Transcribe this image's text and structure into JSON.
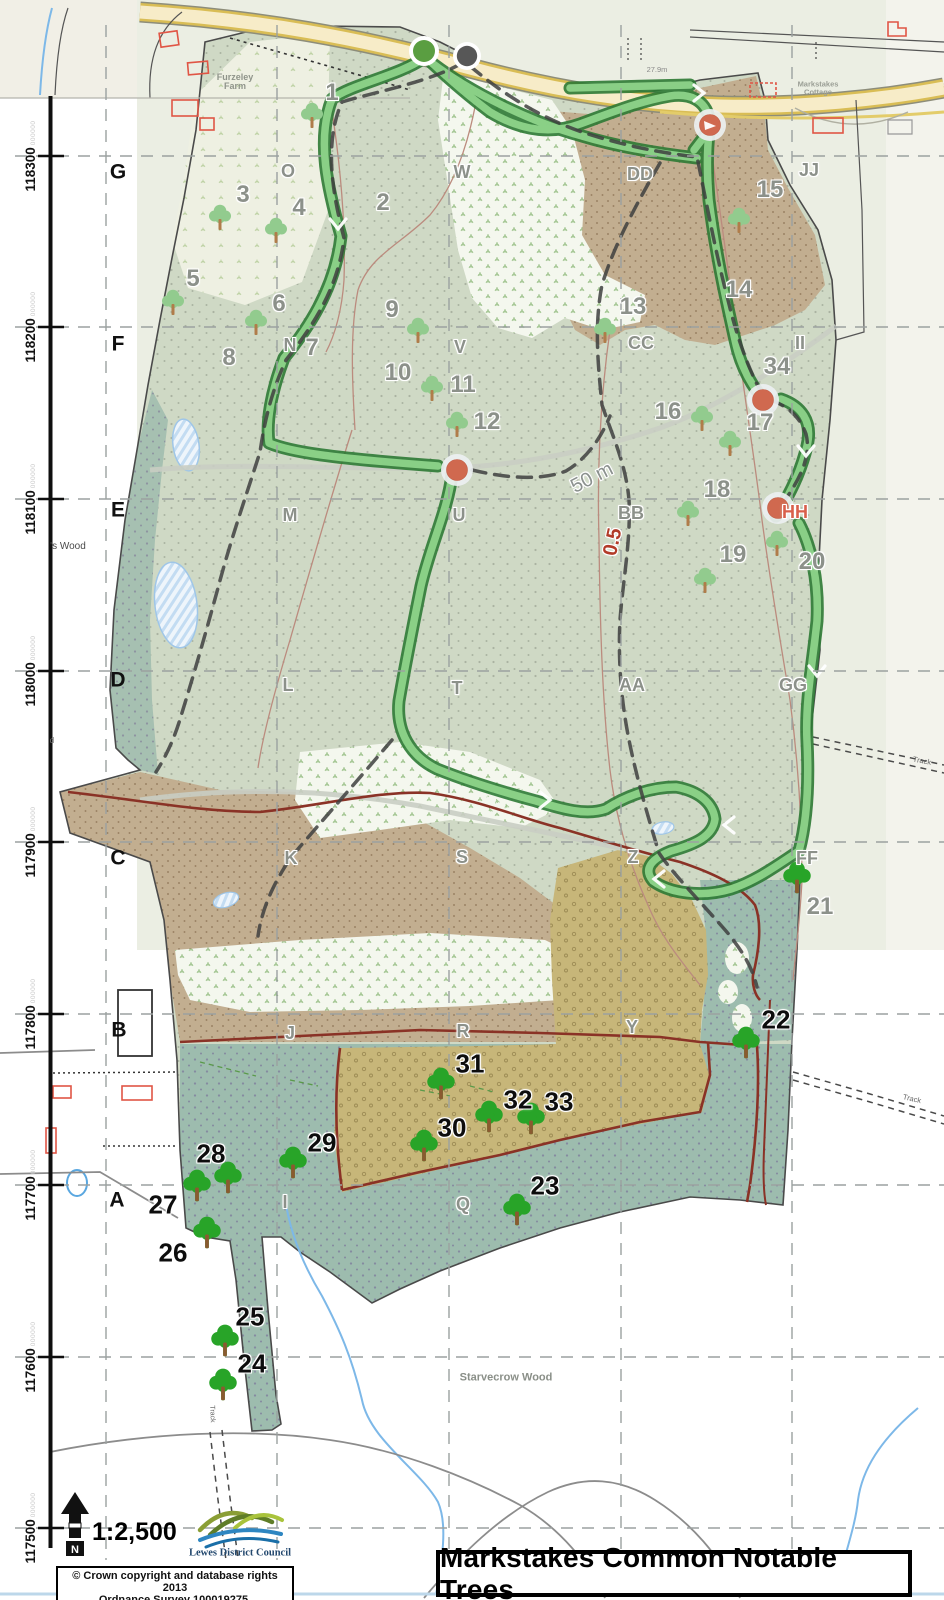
{
  "map": {
    "title": "Markstakes Common Notable Trees",
    "scale_label": "1:2,500",
    "north_label": "N",
    "attribution_line1": "© Crown copyright and database rights 2013",
    "attribution_line2": "Ordnance Survey 100019275.",
    "logo_label": "Lewes District Council",
    "colors": {
      "trail_green": "#8ed48a",
      "trail_casing": "#2e7a35",
      "waypoint_red": "#d0694f",
      "start_green": "#5a9e41",
      "start_gray": "#575757",
      "track_maroon": "#8a3226",
      "stream_blue": "#7db8e8",
      "gray_label": "#8c918a",
      "hh_red": "#d95f4b",
      "road_yellow": "#f6ebc6"
    },
    "grid": {
      "vertical_x": [
        106,
        277,
        449,
        621,
        792
      ],
      "horizontal_y": [
        156,
        327,
        499,
        671,
        842,
        1014,
        1185,
        1357,
        1528
      ]
    },
    "axis_labels": [
      {
        "text": "118300",
        "zeros": "000000",
        "y": 156
      },
      {
        "text": "118200",
        "zeros": "000000",
        "y": 327
      },
      {
        "text": "118100",
        "zeros": "000000",
        "y": 499
      },
      {
        "text": "118000",
        "zeros": "000000",
        "y": 671
      },
      {
        "text": "117900",
        "zeros": "000000",
        "y": 842
      },
      {
        "text": "117800",
        "zeros": "000000",
        "y": 1014
      },
      {
        "text": "117700",
        "zeros": "000000",
        "y": 1185
      },
      {
        "text": "117600",
        "zeros": "000000",
        "y": 1357
      },
      {
        "text": "117500",
        "zeros": "000000",
        "y": 1528
      }
    ],
    "grid_letters": [
      {
        "text": "G",
        "x": 118,
        "y": 172
      },
      {
        "text": "F",
        "x": 118,
        "y": 344
      },
      {
        "text": "E",
        "x": 118,
        "y": 510
      },
      {
        "text": "D",
        "x": 118,
        "y": 680
      },
      {
        "text": "C",
        "x": 118,
        "y": 858
      },
      {
        "text": "B",
        "x": 119,
        "y": 1030
      },
      {
        "text": "A",
        "x": 117,
        "y": 1200
      }
    ],
    "compartment_letters": [
      {
        "text": "O",
        "x": 288,
        "y": 171
      },
      {
        "text": "W",
        "x": 462,
        "y": 172
      },
      {
        "text": "DD",
        "x": 640,
        "y": 174
      },
      {
        "text": "JJ",
        "x": 809,
        "y": 170
      },
      {
        "text": "N",
        "x": 290,
        "y": 345
      },
      {
        "text": "V",
        "x": 460,
        "y": 347
      },
      {
        "text": "CC",
        "x": 641,
        "y": 343
      },
      {
        "text": "II",
        "x": 800,
        "y": 343
      },
      {
        "text": "M",
        "x": 290,
        "y": 515
      },
      {
        "text": "U",
        "x": 459,
        "y": 515
      },
      {
        "text": "BB",
        "x": 631,
        "y": 513
      },
      {
        "text": "HH",
        "x": 795,
        "y": 512,
        "style": "red"
      },
      {
        "text": "L",
        "x": 288,
        "y": 685
      },
      {
        "text": "T",
        "x": 457,
        "y": 688
      },
      {
        "text": "AA",
        "x": 632,
        "y": 685
      },
      {
        "text": "GG",
        "x": 793,
        "y": 685
      },
      {
        "text": "K",
        "x": 291,
        "y": 858
      },
      {
        "text": "S",
        "x": 462,
        "y": 857
      },
      {
        "text": "Z",
        "x": 633,
        "y": 857
      },
      {
        "text": "FF",
        "x": 807,
        "y": 858
      },
      {
        "text": "J",
        "x": 290,
        "y": 1033
      },
      {
        "text": "R",
        "x": 463,
        "y": 1031
      },
      {
        "text": "Y",
        "x": 632,
        "y": 1027
      },
      {
        "text": "I",
        "x": 285,
        "y": 1202
      },
      {
        "text": "Q",
        "x": 463,
        "y": 1204
      }
    ],
    "tree_numbers": [
      {
        "n": "1",
        "x": 332,
        "y": 93,
        "style": "gray"
      },
      {
        "n": "2",
        "x": 383,
        "y": 203,
        "style": "gray"
      },
      {
        "n": "3",
        "x": 243,
        "y": 195,
        "style": "gray"
      },
      {
        "n": "4",
        "x": 299,
        "y": 208,
        "style": "gray"
      },
      {
        "n": "5",
        "x": 193,
        "y": 279,
        "style": "gray"
      },
      {
        "n": "6",
        "x": 279,
        "y": 304,
        "style": "gray"
      },
      {
        "n": "7",
        "x": 312,
        "y": 348,
        "style": "gray"
      },
      {
        "n": "8",
        "x": 229,
        "y": 358,
        "style": "gray"
      },
      {
        "n": "9",
        "x": 392,
        "y": 310,
        "style": "gray"
      },
      {
        "n": "10",
        "x": 398,
        "y": 373,
        "style": "gray"
      },
      {
        "n": "11",
        "x": 463,
        "y": 385,
        "style": "gray"
      },
      {
        "n": "12",
        "x": 487,
        "y": 422,
        "style": "gray"
      },
      {
        "n": "13",
        "x": 633,
        "y": 307,
        "style": "gray"
      },
      {
        "n": "14",
        "x": 739,
        "y": 290,
        "style": "gray"
      },
      {
        "n": "15",
        "x": 770,
        "y": 190,
        "style": "gray"
      },
      {
        "n": "16",
        "x": 668,
        "y": 412,
        "style": "gray"
      },
      {
        "n": "17",
        "x": 760,
        "y": 423,
        "style": "gray"
      },
      {
        "n": "18",
        "x": 717,
        "y": 490,
        "style": "gray"
      },
      {
        "n": "19",
        "x": 733,
        "y": 555,
        "style": "gray"
      },
      {
        "n": "20",
        "x": 812,
        "y": 562,
        "style": "gray"
      },
      {
        "n": "21",
        "x": 820,
        "y": 907,
        "style": "gray"
      },
      {
        "n": "34",
        "x": 777,
        "y": 367,
        "style": "gray"
      },
      {
        "n": "22",
        "x": 776,
        "y": 1020,
        "style": "black"
      },
      {
        "n": "23",
        "x": 545,
        "y": 1186,
        "style": "black"
      },
      {
        "n": "24",
        "x": 252,
        "y": 1364,
        "style": "black"
      },
      {
        "n": "25",
        "x": 250,
        "y": 1317,
        "style": "black"
      },
      {
        "n": "26",
        "x": 173,
        "y": 1253,
        "style": "black"
      },
      {
        "n": "27",
        "x": 163,
        "y": 1205,
        "style": "black"
      },
      {
        "n": "28",
        "x": 211,
        "y": 1154,
        "style": "black"
      },
      {
        "n": "29",
        "x": 322,
        "y": 1143,
        "style": "black"
      },
      {
        "n": "30",
        "x": 452,
        "y": 1128,
        "style": "black"
      },
      {
        "n": "31",
        "x": 470,
        "y": 1064,
        "style": "black"
      },
      {
        "n": "32",
        "x": 518,
        "y": 1100,
        "style": "black"
      },
      {
        "n": "33",
        "x": 559,
        "y": 1102,
        "style": "black"
      }
    ],
    "tree_icons": {
      "light": [
        [
          312,
          115
        ],
        [
          220,
          217
        ],
        [
          276,
          230
        ],
        [
          173,
          302
        ],
        [
          256,
          322
        ],
        [
          418,
          330
        ],
        [
          432,
          388
        ],
        [
          457,
          424
        ],
        [
          605,
          330
        ],
        [
          739,
          220
        ],
        [
          702,
          418
        ],
        [
          730,
          443
        ],
        [
          688,
          513
        ],
        [
          705,
          580
        ],
        [
          777,
          543
        ]
      ],
      "dark": [
        [
          197,
          1188
        ],
        [
          228,
          1180
        ],
        [
          293,
          1165
        ],
        [
          207,
          1235
        ],
        [
          424,
          1148
        ],
        [
          441,
          1086
        ],
        [
          489,
          1119
        ],
        [
          531,
          1121
        ],
        [
          517,
          1212
        ],
        [
          746,
          1045
        ],
        [
          225,
          1343
        ],
        [
          223,
          1387
        ],
        [
          797,
          880
        ]
      ]
    },
    "waypoint_markers": [
      {
        "x": 710,
        "y": 125,
        "arrow": true
      },
      {
        "x": 457,
        "y": 470,
        "arrow": false
      },
      {
        "x": 763,
        "y": 400,
        "arrow": false
      },
      {
        "x": 778,
        "y": 508,
        "arrow": false
      }
    ],
    "start_markers": [
      {
        "x": 424,
        "y": 51,
        "kind": "green"
      },
      {
        "x": 467,
        "y": 56,
        "kind": "dark"
      }
    ],
    "place_labels": [
      {
        "lines": [
          "Furzeley",
          "Farm"
        ],
        "x": 235,
        "y": 82,
        "size": 9,
        "color": "#8f948a",
        "bold": true,
        "rot": 0,
        "halo": false
      },
      {
        "lines": [
          "Markstakes",
          "Cottage"
        ],
        "x": 818,
        "y": 88,
        "size": 7.5,
        "color": "#9a9e95",
        "bold": true,
        "rot": 0,
        "halo": false
      },
      {
        "lines": [
          "'s Wood"
        ],
        "x": 68,
        "y": 547,
        "size": 10,
        "color": "#4a4a4a",
        "bold": false,
        "rot": 0,
        "halo": false
      },
      {
        "lines": [
          "d"
        ],
        "x": 52,
        "y": 741,
        "size": 8,
        "color": "#777777",
        "bold": false,
        "rot": 0,
        "halo": false
      },
      {
        "lines": [
          "Starvecrow Wood"
        ],
        "x": 506,
        "y": 1378,
        "size": 11,
        "color": "#8a8f88",
        "bold": true,
        "rot": 0,
        "halo": false
      },
      {
        "lines": [
          "27.9m"
        ],
        "x": 657,
        "y": 70,
        "size": 7.5,
        "color": "#8a8a8a",
        "bold": false,
        "rot": 0,
        "halo": false
      },
      {
        "lines": [
          "50 m"
        ],
        "x": 592,
        "y": 478,
        "size": 20,
        "color": "#8b918e",
        "bold": false,
        "rot": -27,
        "halo": true
      },
      {
        "lines": [
          "0.5"
        ],
        "x": 613,
        "y": 542,
        "size": 20,
        "color": "#b23b28",
        "bold": true,
        "rot": -78,
        "halo": true
      },
      {
        "lines": [
          "Track"
        ],
        "x": 922,
        "y": 761,
        "size": 7.5,
        "color": "#666666",
        "bold": false,
        "rot": 11,
        "halo": false
      },
      {
        "lines": [
          "Track"
        ],
        "x": 912,
        "y": 1099,
        "size": 7.5,
        "color": "#666666",
        "bold": false,
        "rot": 13,
        "halo": false
      },
      {
        "lines": [
          "Track"
        ],
        "x": 212,
        "y": 1414,
        "size": 7,
        "color": "#666666",
        "bold": false,
        "rot": 88,
        "halo": false
      }
    ]
  }
}
